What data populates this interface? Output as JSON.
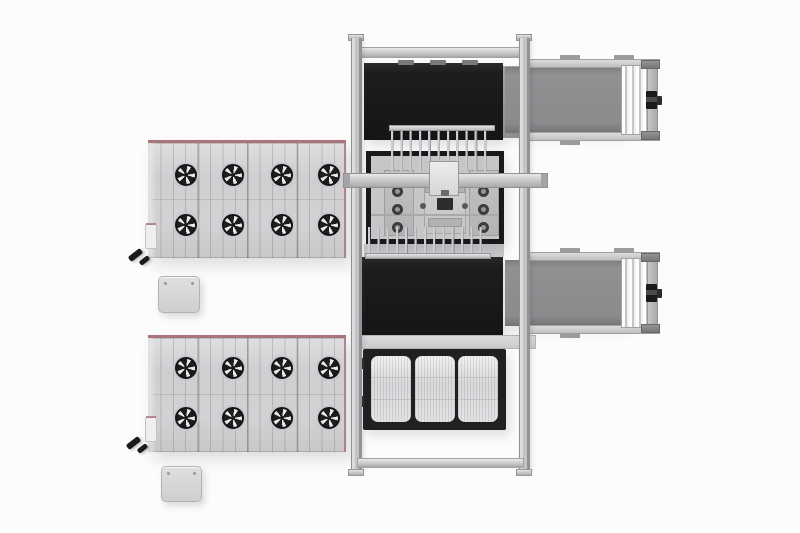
{
  "scene": {
    "description": "Top view 3D render of an automated panel production line with cooling tables, gantry loader and outfeed conveyors",
    "background": "#fcfcfd"
  },
  "colors": {
    "scene-bg": "#fcfcfd",
    "panel-gray": "#d2d2d4",
    "panel-edge": "#e9e9ea",
    "accent-red": "#a9747a",
    "fan-dark": "#1d1d1f",
    "fan-blade": "#e9e9ea",
    "frame-silver": "#c7c7c9",
    "rail-dark-edge": "#929294",
    "black-unit": "#1d1d1f",
    "belt-gray": "#8b8b8d",
    "roller-white": "#f1f1f2",
    "pallet-frame": "#202022",
    "pallet-cell": "#e3e3e5",
    "box-gray": "#d7d7d9",
    "motor-black": "#1a1a1c"
  },
  "components": {
    "cooling_panel_top": {
      "label": "Upper cooling table with 8 fans",
      "fan_count": 8
    },
    "cooling_panel_bottom": {
      "label": "Lower cooling table with 8 fans",
      "fan_count": 8
    },
    "side_box_top": {
      "label": "Side junction box (upper table)"
    },
    "side_box_bottom": {
      "label": "Side junction box (lower table)"
    },
    "clamp_top": {
      "label": "Clamp sensor near upper table corner"
    },
    "clamp_bottom": {
      "label": "Clamp sensor near lower table corner"
    },
    "control_box_top": {
      "label": "Control box (upper)"
    },
    "control_box_bottom": {
      "label": "Control box (lower)"
    },
    "gantry_frame": {
      "label": "Gantry support frame"
    },
    "infeed_black_conveyor": {
      "label": "Infeed conveyor section (black)"
    },
    "transfer_comb_upper": {
      "label": "Upper transfer comb",
      "tine_count": 11
    },
    "process_table": {
      "label": "Processing table with tooling and suction rings",
      "ring_count": 6
    },
    "crossbeam": {
      "label": "Gantry crossbeam"
    },
    "toolhead_carriage": {
      "label": "Toolhead carriage"
    },
    "transfer_comb_lower": {
      "label": "Lower transfer comb",
      "tine_count": 13
    },
    "buffer_black_conveyor": {
      "label": "Buffer conveyor section (black)"
    },
    "pallet_station": {
      "label": "Pallet station with 3 glass panels",
      "cell_count": 3
    },
    "outfeed_conveyor_upper": {
      "label": "Upper outfeed belt conveyor with drive motor"
    },
    "outfeed_conveyor_lower": {
      "label": "Lower outfeed belt conveyor with drive motor"
    }
  }
}
